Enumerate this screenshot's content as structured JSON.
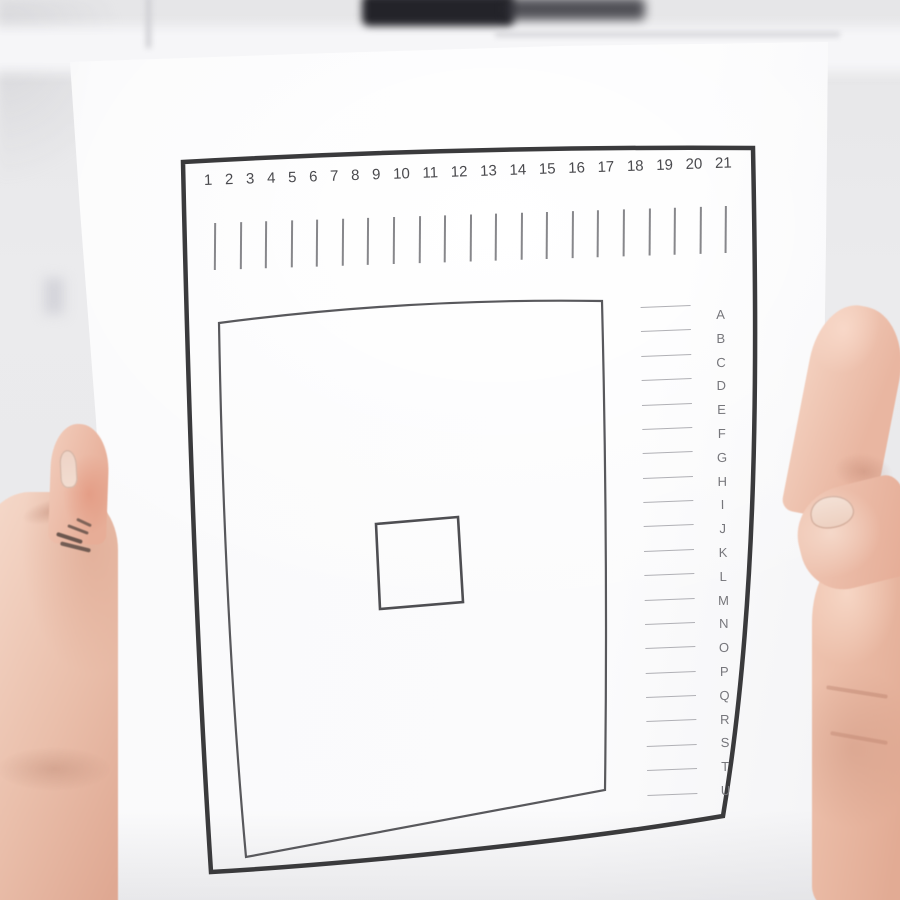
{
  "colors": {
    "background": "#e9e9eb",
    "paper": "#fbfbfc",
    "frame": "#3a3a3c",
    "print-gray": "#58585c",
    "square-gray": "#4e4e52",
    "number-gray": "#4a4a4e",
    "tick-gray": "#87878b",
    "letter-gray": "#76767b",
    "line-light": "#b0b0b5",
    "skin": "#eec3b1",
    "skin-shadow": "#dfa892",
    "marker-dark": "#232329",
    "nail": "#f2ddd1"
  },
  "sheet": {
    "numbers": [
      "1",
      "2",
      "3",
      "4",
      "5",
      "6",
      "7",
      "8",
      "9",
      "10",
      "11",
      "12",
      "13",
      "14",
      "15",
      "16",
      "17",
      "18",
      "19",
      "20",
      "21"
    ],
    "letters": [
      "A",
      "B",
      "C",
      "D",
      "E",
      "F",
      "G",
      "H",
      "I",
      "J",
      "K",
      "L",
      "M",
      "N",
      "O",
      "P",
      "Q",
      "R",
      "S",
      "T",
      "U"
    ]
  }
}
